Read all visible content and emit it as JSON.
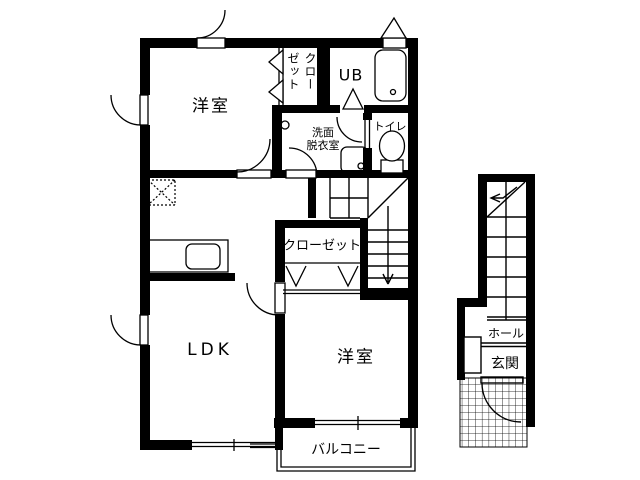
{
  "labels": {
    "room_top": "洋室",
    "closet_top": "クローゼット",
    "ub": "UB",
    "washroom_line1": "洗面",
    "washroom_line2": "脱衣室",
    "toilet": "トイレ",
    "closet_center": "クローゼット",
    "ldk": "LDK",
    "room_bottom": "洋室",
    "balcony": "バルコニー",
    "hall": "ホール",
    "entrance": "玄関"
  },
  "colors": {
    "line": "#000000",
    "background": "#ffffff"
  }
}
